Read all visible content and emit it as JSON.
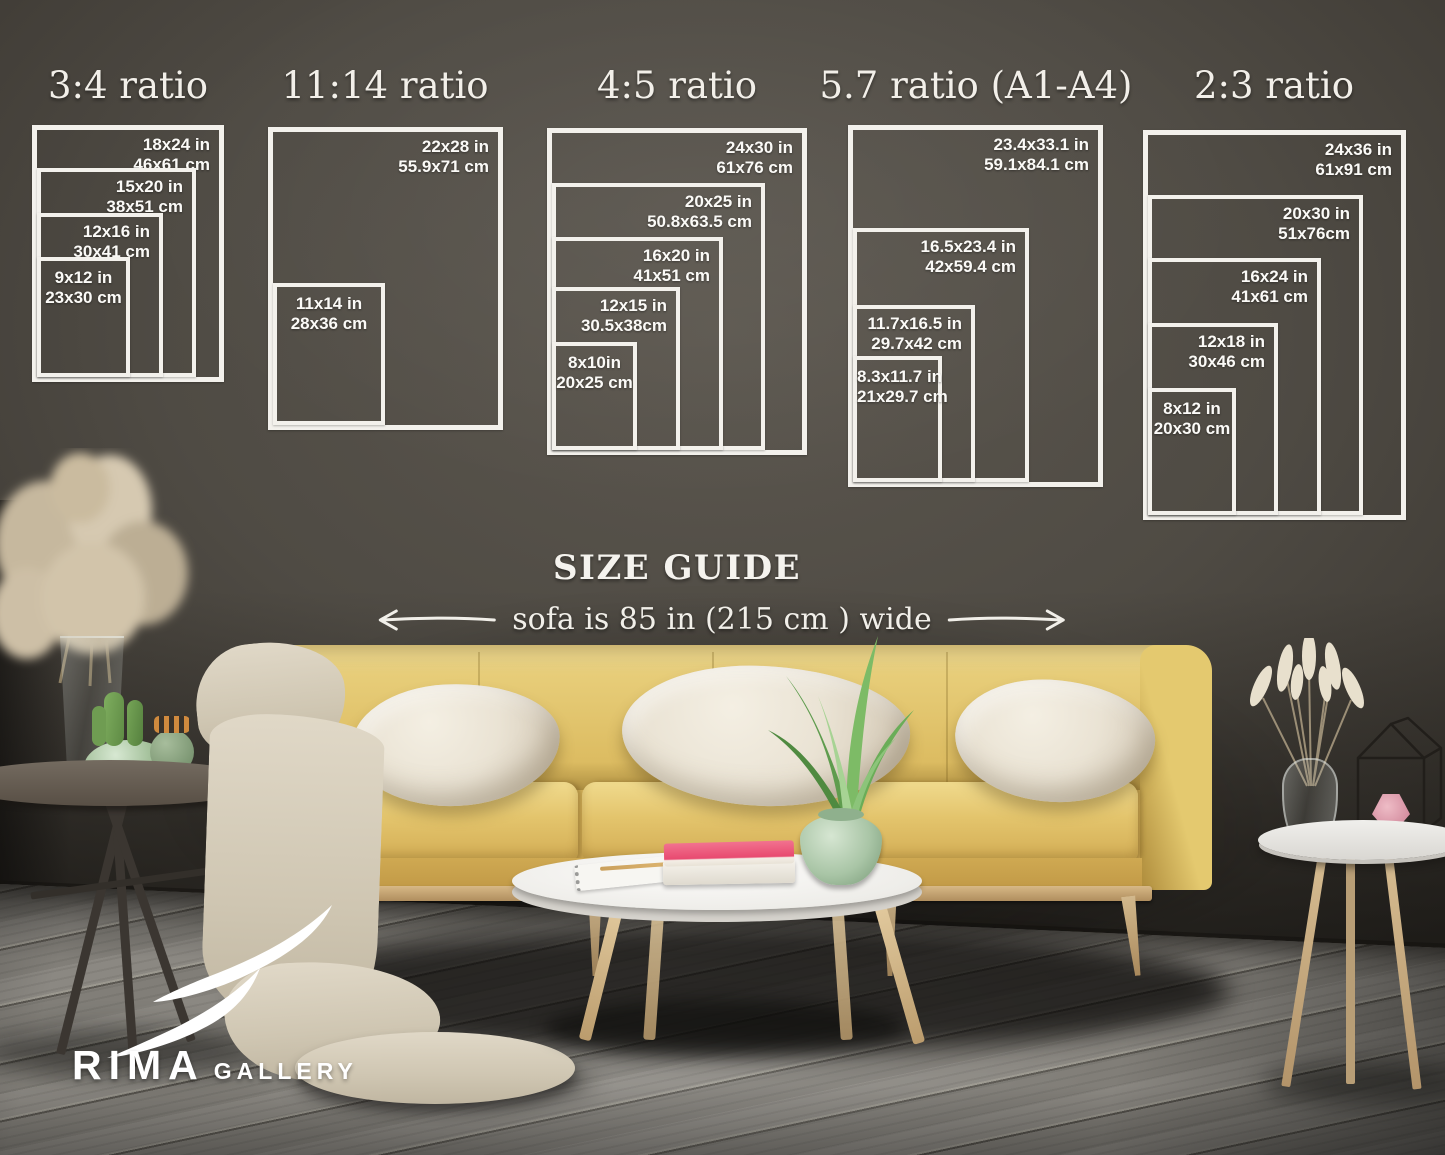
{
  "size_guide": {
    "heading": "SIZE GUIDE",
    "sofa_note": "sofa is 85 in (215 cm ) wide",
    "groups": [
      {
        "ratio": "3:4 ratio",
        "sizes": [
          {
            "in": "18x24 in",
            "cm": "46x61 cm"
          },
          {
            "in": "15x20 in",
            "cm": "38x51 cm"
          },
          {
            "in": "12x16 in",
            "cm": "30x41 cm"
          },
          {
            "in": "9x12 in",
            "cm": "23x30 cm"
          }
        ]
      },
      {
        "ratio": "11:14 ratio",
        "sizes": [
          {
            "in": "22x28 in",
            "cm": "55.9x71 cm"
          },
          {
            "in": "11x14 in",
            "cm": "28x36 cm"
          }
        ]
      },
      {
        "ratio": "4:5 ratio",
        "sizes": [
          {
            "in": "24x30 in",
            "cm": "61x76 cm"
          },
          {
            "in": "20x25 in",
            "cm": "50.8x63.5 cm"
          },
          {
            "in": "16x20 in",
            "cm": "41x51 cm"
          },
          {
            "in": "12x15 in",
            "cm": "30.5x38cm"
          },
          {
            "in": "8x10in",
            "cm": "20x25 cm"
          }
        ]
      },
      {
        "ratio": "5.7 ratio (A1-A4)",
        "sizes": [
          {
            "in": "23.4x33.1 in",
            "cm": "59.1x84.1 cm"
          },
          {
            "in": "16.5x23.4 in",
            "cm": "42x59.4 cm"
          },
          {
            "in": "11.7x16.5 in",
            "cm": "29.7x42 cm"
          },
          {
            "in": "8.3x11.7 in",
            "cm": "21x29.7 cm"
          }
        ]
      },
      {
        "ratio": "2:3 ratio",
        "sizes": [
          {
            "in": "24x36 in",
            "cm": "61x91 cm"
          },
          {
            "in": "20x30 in",
            "cm": "51x76cm"
          },
          {
            "in": "16x24 in",
            "cm": "41x61 cm"
          },
          {
            "in": "12x18 in",
            "cm": "30x46 cm"
          },
          {
            "in": "8x12 in",
            "cm": "20x30 cm"
          }
        ]
      }
    ]
  },
  "brand": {
    "name": "RIMA",
    "suffix": "GALLERY"
  },
  "colors": {
    "wall": "#4f4b44",
    "floor": "#7d7a74",
    "frame_line": "#f3f1ec",
    "sofa_yellow": "#ddbd63",
    "pillow_cream": "#eae3d4",
    "book_pink": "#e84a70",
    "vase_green": "#a9c5a6",
    "text": "#f5f3ee"
  }
}
